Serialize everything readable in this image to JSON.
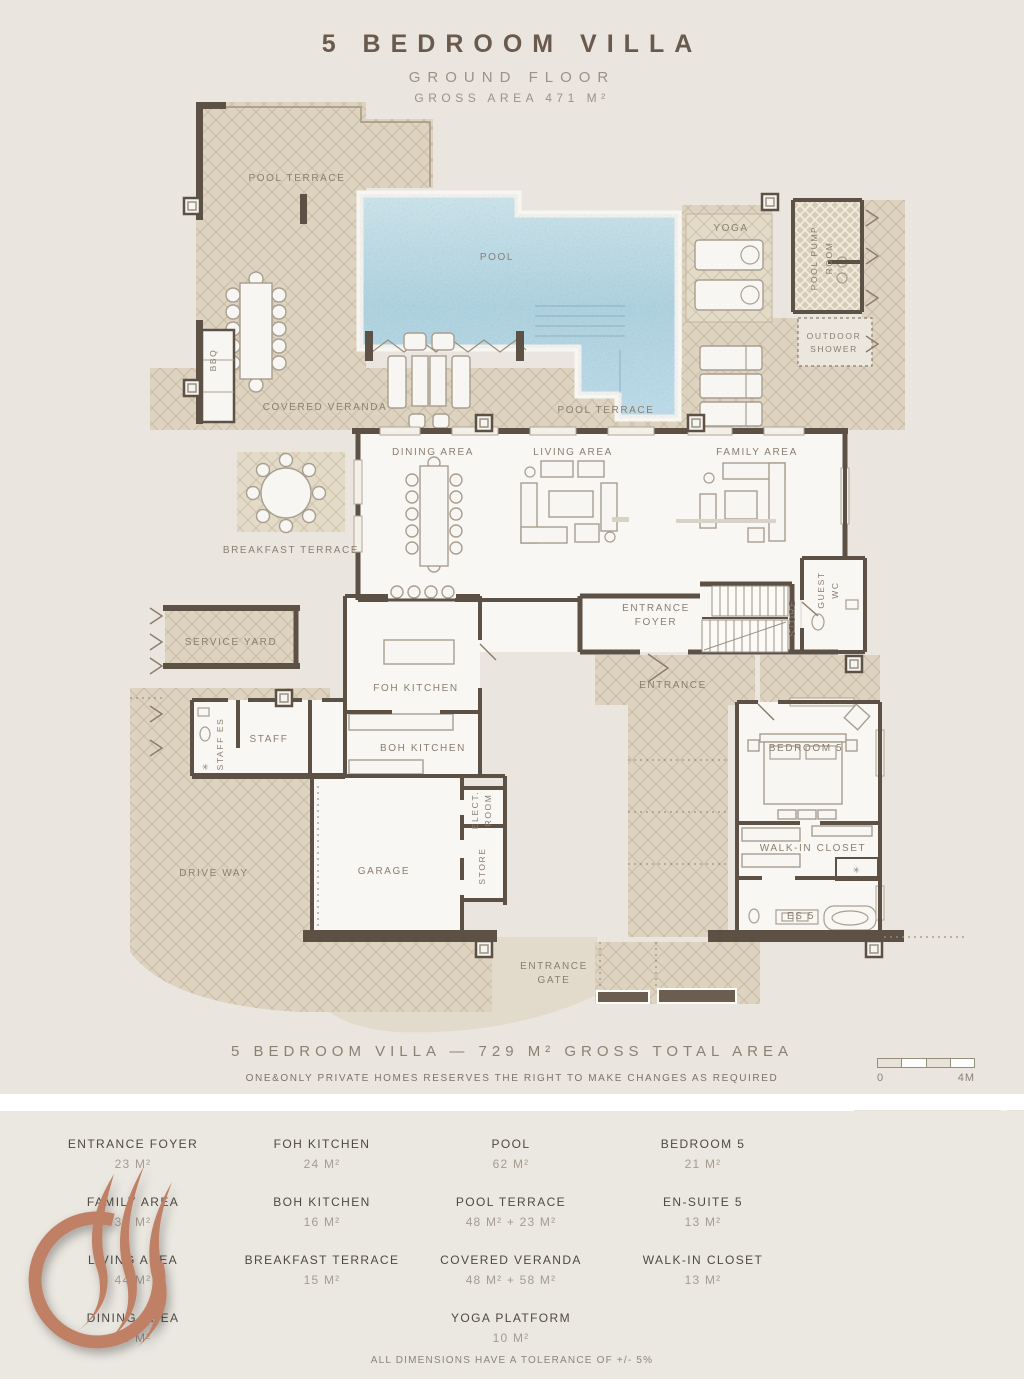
{
  "header": {
    "title": "5 BEDROOM VILLA",
    "floor": "GROUND FLOOR",
    "gross_area": "GROSS AREA 471 M²"
  },
  "plan": {
    "labels": {
      "pool_terrace_top": "POOL TERRACE",
      "pool": "POOL",
      "yoga": "YOGA",
      "pool_pump_room": [
        "POOL PUMP",
        "ROOM"
      ],
      "outdoor_shower": [
        "OUTDOOR",
        "SHOWER"
      ],
      "bbq": "BBQ",
      "covered_veranda": "COVERED VERANDA",
      "pool_terrace_right": "POOL TERRACE",
      "dining_area": "DINING AREA",
      "living_area": "LIVING AREA",
      "family_area": "FAMILY AREA",
      "breakfast_terrace": "BREAKFAST TERRACE",
      "guest_wc": [
        "GUEST",
        "WC"
      ],
      "store_upper": "STORE",
      "entrance_foyer": [
        "ENTRANCE",
        "FOYER"
      ],
      "entrance": "ENTRANCE",
      "service_yard": "SERVICE YARD",
      "foh_kitchen": "FOH KITCHEN",
      "staff": "STAFF",
      "staff_es": "STAFF ES",
      "boh_kitchen": "BOH KITCHEN",
      "elect_room": [
        "ELECT.",
        "ROOM"
      ],
      "store_lower": "STORE",
      "garage": "GARAGE",
      "drive_way": "DRIVE WAY",
      "bedroom_5": "BEDROOM 5",
      "walk_in_closet": "WALK-IN CLOSET",
      "es_5": "ES 5",
      "entrance_gate": [
        "ENTRANCE",
        "GATE"
      ]
    }
  },
  "footer": {
    "total": "5 BEDROOM VILLA — 729 M² GROSS TOTAL AREA",
    "disclaimer": "ONE&ONLY PRIVATE HOMES RESERVES THE RIGHT TO MAKE CHANGES AS REQUIRED",
    "scale": {
      "start": "0",
      "end": "4M"
    }
  },
  "legend": {
    "columns": [
      {
        "items": [
          {
            "name": "ENTRANCE FOYER",
            "area": "23 M²"
          },
          {
            "name": "FAMILY AREA",
            "area": "36 M²"
          },
          {
            "name": "LIVING AREA",
            "area": "44 M²"
          },
          {
            "name": "DINING AREA",
            "area": "38 M²"
          }
        ]
      },
      {
        "items": [
          {
            "name": "FOH KITCHEN",
            "area": "24 M²"
          },
          {
            "name": "BOH KITCHEN",
            "area": "16 M²"
          },
          {
            "name": "BREAKFAST TERRACE",
            "area": "15 M²"
          }
        ]
      },
      {
        "items": [
          {
            "name": "POOL",
            "area": "62 M²"
          },
          {
            "name": "POOL TERRACE",
            "area": "48 M² + 23 M²"
          },
          {
            "name": "COVERED VERANDA",
            "area": "48 M² + 58 M²"
          },
          {
            "name": "YOGA PLATFORM",
            "area": "10 M²"
          }
        ]
      },
      {
        "items": [
          {
            "name": "BEDROOM 5",
            "area": "21 M²"
          },
          {
            "name": "EN-SUITE 5",
            "area": "13 M²"
          },
          {
            "name": "WALK-IN CLOSET",
            "area": "13 M²"
          }
        ]
      }
    ],
    "note": "ALL DIMENSIONS HAVE A TOLERANCE OF +/- 5%"
  },
  "map": {
    "caption": [
      "VILLA",
      "LOCATION"
    ]
  },
  "colors": {
    "wall": "#5d5044",
    "hatch": "#ddd3c0",
    "pool": "#aed4e3",
    "logo": "#bf8065",
    "text_dark": "#6a5a4d",
    "text_muted": "#9a9083",
    "room_label": "#8a7e6f"
  }
}
